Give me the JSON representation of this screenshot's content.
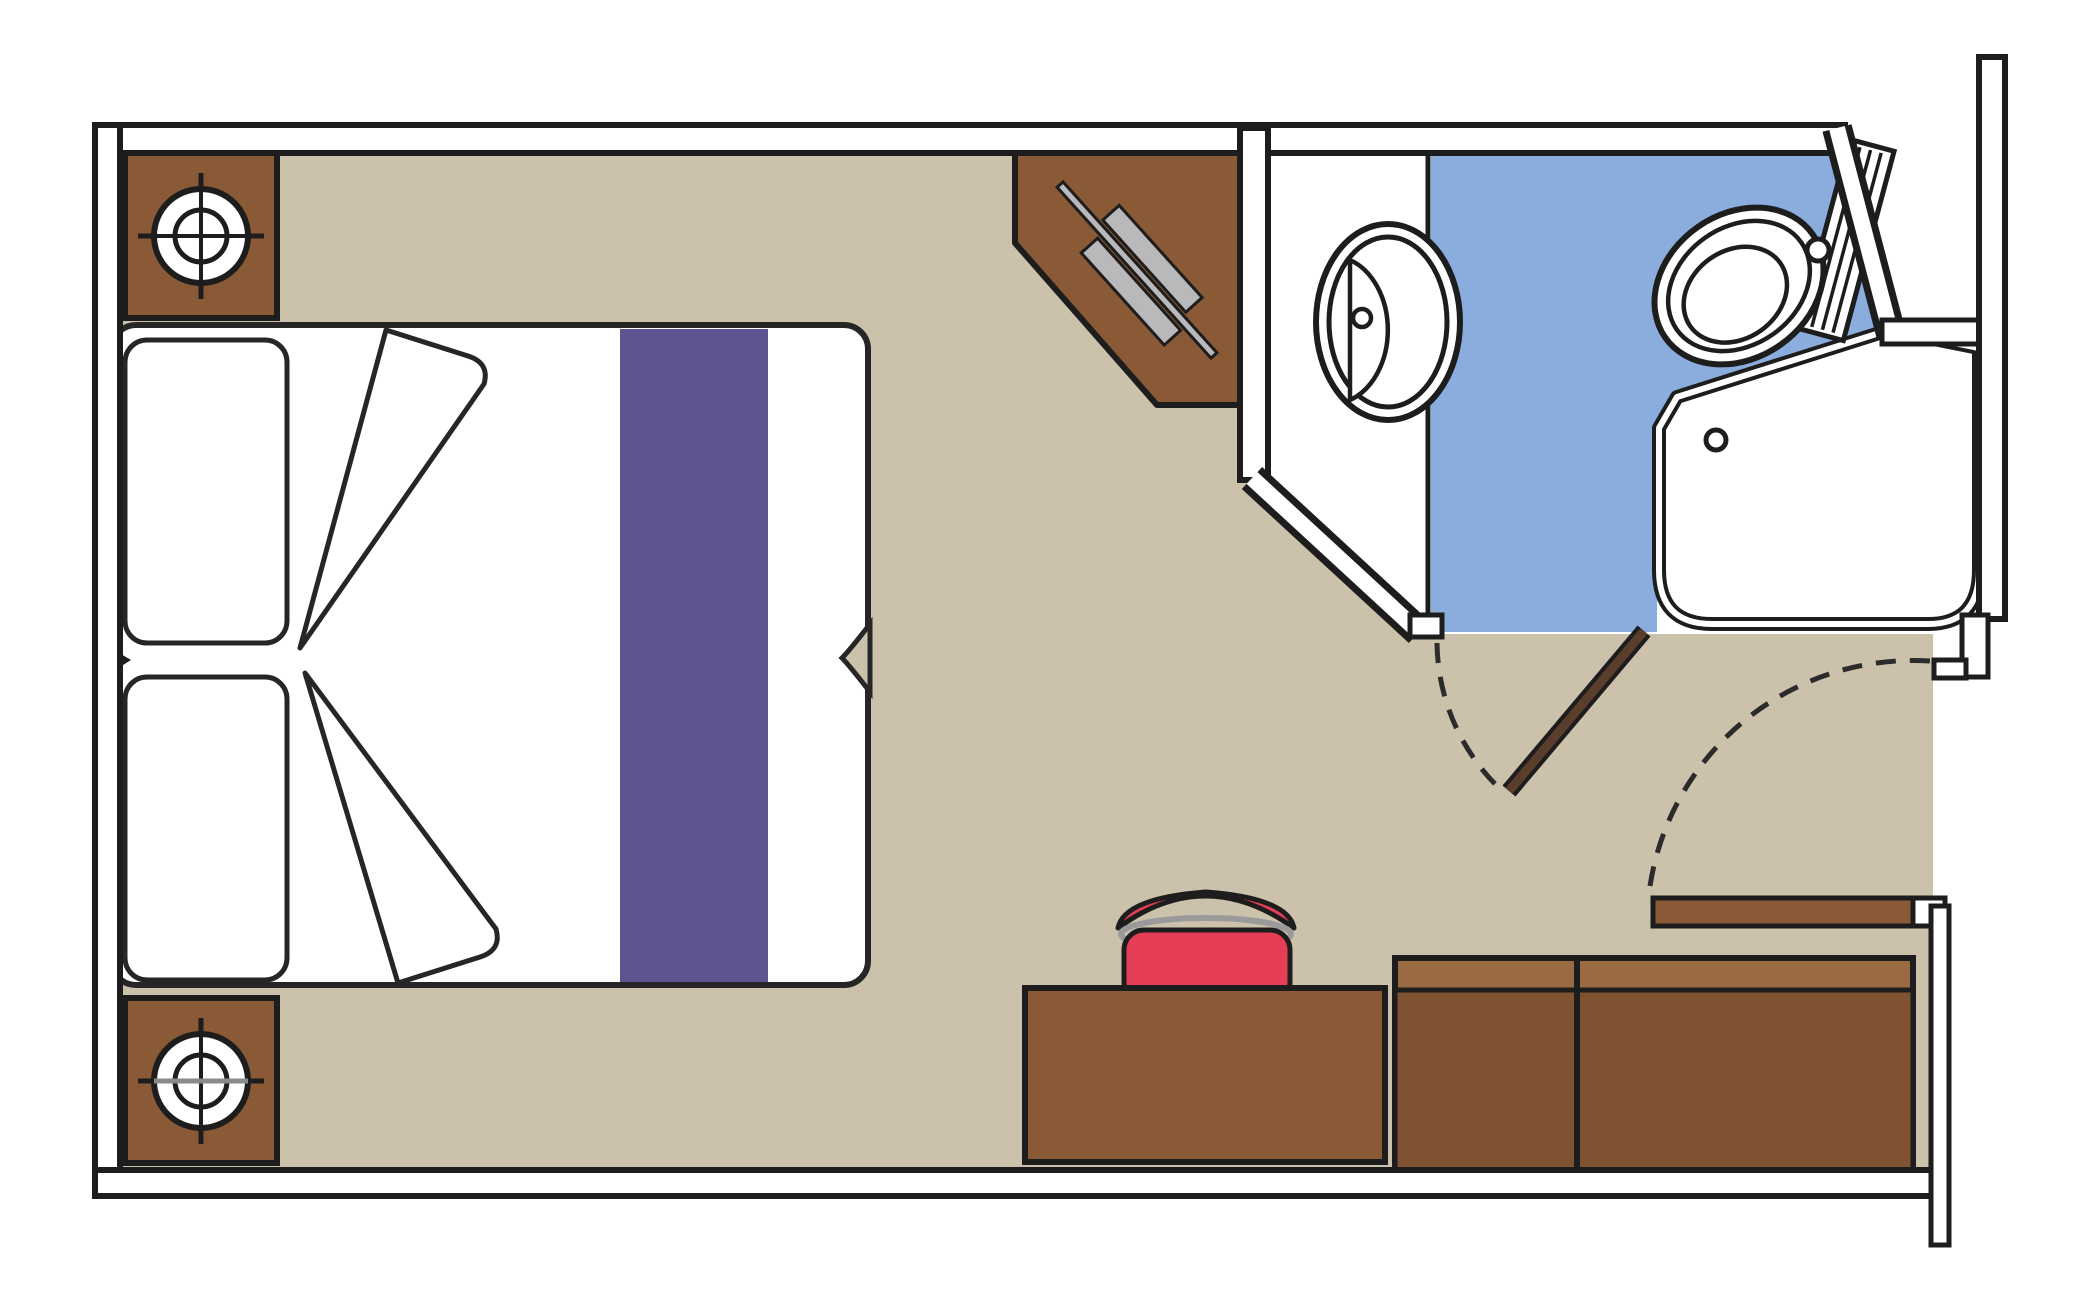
{
  "meta": {
    "title": "Cruise ship cabin floor plan",
    "diagram_type": "floor-plan",
    "room_count": 2,
    "rooms": [
      "cabin",
      "bathroom"
    ]
  },
  "colors": {
    "wall": "#ffffff",
    "wall_line": "#1d1d1d",
    "outline": "#262626",
    "floor_tan": "#ccc2ac",
    "bathroom_blue": "#8badde",
    "white": "#ffffff",
    "wood": "#8a5a36",
    "wood_light": "#9a6a42",
    "wood_dark": "#7f5231",
    "bed_runner_purple": "#5e5490",
    "stool_red": "#e63e56",
    "tv_gray": "#b9b9bb",
    "ring_gray": "#9a9a9a",
    "lamp_axis_gray": "#8a8a8a",
    "door_leaf_brown": "#5a3e2b"
  },
  "items": [
    {
      "name": "double-bed",
      "details": "two pillows, purple runner stripe, fold lines, twin-join notch"
    },
    {
      "name": "nightstand-top",
      "details": "square cabinet with reading lamp symbol"
    },
    {
      "name": "nightstand-bottom",
      "details": "square cabinet with reading lamp symbol"
    },
    {
      "name": "corner-tv-cabinet",
      "details": "angled corner unit with wall-mounted TV symbol"
    },
    {
      "name": "desk",
      "details": "dressing table against bottom wall"
    },
    {
      "name": "stool",
      "details": "red upholstered pouf at desk"
    },
    {
      "name": "wardrobe",
      "details": "two-door closet, bottom right"
    },
    {
      "name": "sink-vanity",
      "details": "bathroom counter with oval washbasin and drain"
    },
    {
      "name": "toilet",
      "details": "corner-angled toilet with tank and flush button"
    },
    {
      "name": "shower",
      "details": "shower enclosure with drain, rounded corner"
    },
    {
      "name": "bathroom-door",
      "details": "inward swinging door with dashed swing arc"
    },
    {
      "name": "entrance-door",
      "details": "cabin entry door with dashed swing arc"
    }
  ]
}
